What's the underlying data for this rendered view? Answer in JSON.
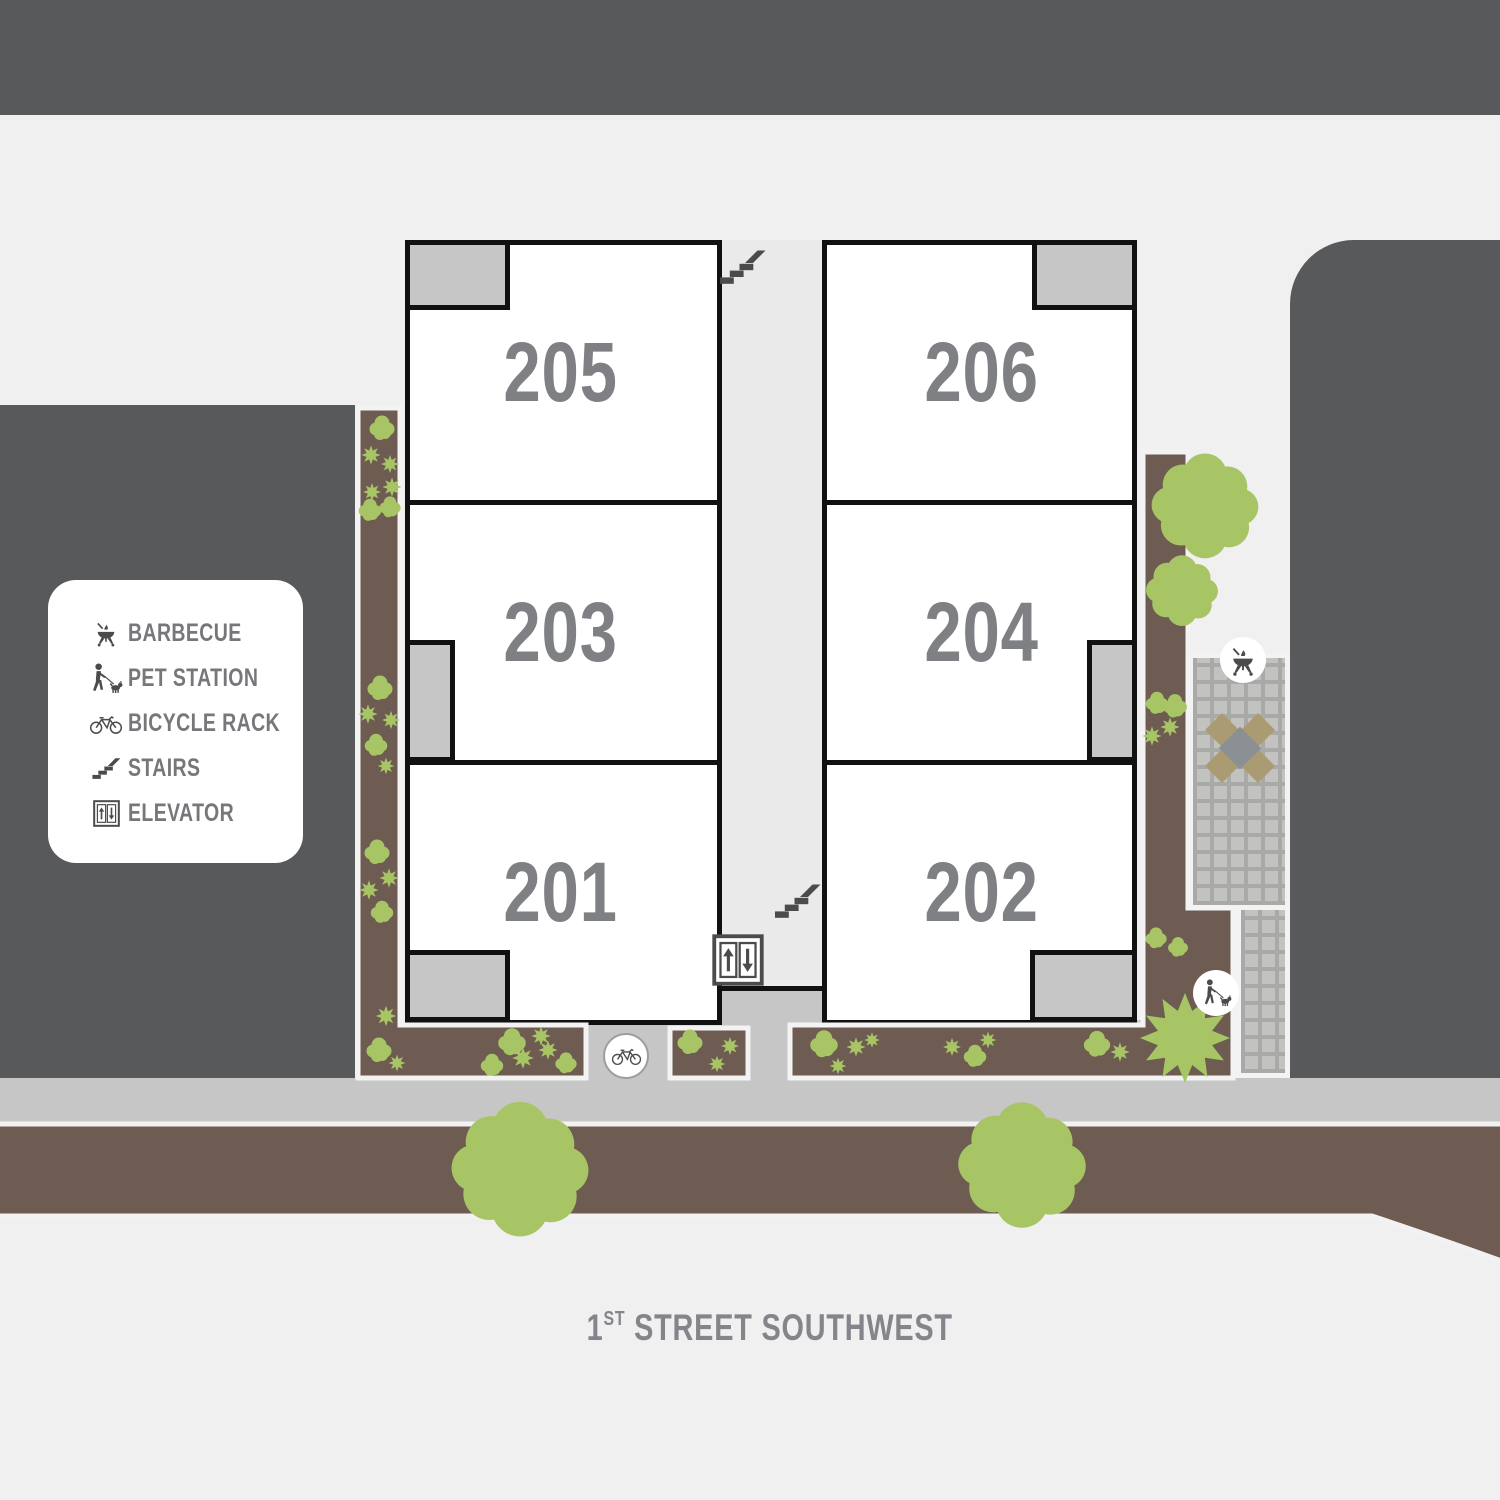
{
  "legend": {
    "items": [
      {
        "icon": "barbecue-icon",
        "label": "BARBECUE"
      },
      {
        "icon": "pet-station-icon",
        "label": "PET STATION"
      },
      {
        "icon": "bicycle-rack-icon",
        "label": "BICYCLE RACK"
      },
      {
        "icon": "stairs-icon",
        "label": "STAIRS"
      },
      {
        "icon": "elevator-icon",
        "label": "ELEVATOR"
      }
    ]
  },
  "units": [
    {
      "number": "205"
    },
    {
      "number": "203"
    },
    {
      "number": "201"
    },
    {
      "number": "206"
    },
    {
      "number": "204"
    },
    {
      "number": "202"
    }
  ],
  "street": {
    "number": "1",
    "ordinal": "ST",
    "name": "STREET SOUTHWEST"
  },
  "map_markers": [
    "stairs-icon",
    "stairs-icon",
    "elevator-icon",
    "barbecue-icon",
    "pet-station-icon",
    "bicycle-rack-icon"
  ],
  "colors": {
    "building_block": "#58595b",
    "background": "#f0f0f1",
    "sidewalk": "#c6c6c6",
    "planting_bed": "#6e5c52",
    "vegetation": "#a8c566",
    "wall": "#111111",
    "unit_number": "#7e8083",
    "legend_text": "#76777a",
    "icon": "#4a4b4d",
    "corridor": "#e9eae9",
    "tile_light": "#c2c2c0",
    "tile_grout": "#a9a9a7",
    "table_tan": "#ab9b73",
    "table_gray": "#8b9094"
  }
}
